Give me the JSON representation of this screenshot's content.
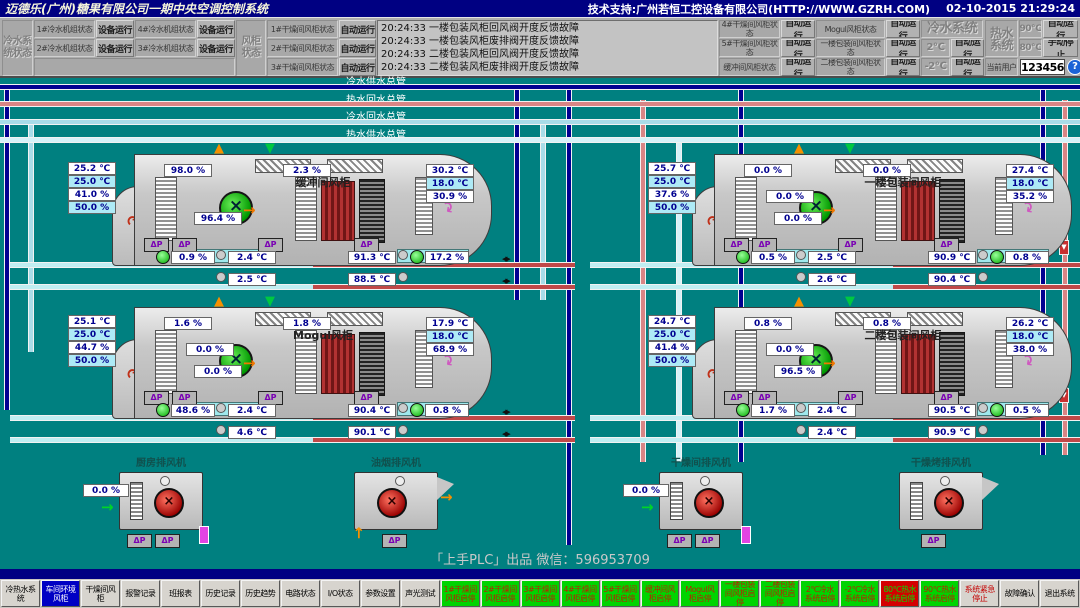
{
  "colors": {
    "background": "#008080",
    "titlebar": "#000082",
    "run_green": "#00d400",
    "stop_red": "#d40000",
    "active_blue": "#0000c4",
    "setpoint_cyan": "#aeeaf6"
  },
  "title_bar": {
    "title": "迈德乐(广州)糖果有限公司一期中央空调控制系统",
    "support": "技术支持:广州若恒工控设备有限公司(HTTP://WWW.GZRH.COM)",
    "datetime": "02-10-2015 21:29:24"
  },
  "labels": {
    "dp": "ΔP"
  },
  "status_panel": {
    "chiller_group": "冷水系统状态",
    "chiller_rows": [
      {
        "l1": "1#冷水机组状态",
        "v1": "设备运行",
        "l2": "4#冷水机组状态",
        "v2": "设备运行"
      },
      {
        "l1": "2#冷水机组状态",
        "v1": "设备运行",
        "l2": "3#冷水机组状态",
        "v2": "设备运行"
      }
    ],
    "ahu_group": "风柜状态",
    "ahu_left_rows": [
      {
        "l": "1#干燥间风柜状态",
        "v": "自动运行"
      },
      {
        "l": "2#干燥间风柜状态",
        "v": "自动运行"
      },
      {
        "l": "3#干燥间风柜状态",
        "v": "自动运行"
      }
    ],
    "alarms": [
      {
        "time": "20:24:33",
        "text": "一楼包装风柜回风阀开度反馈故障"
      },
      {
        "time": "20:24:33",
        "text": "一楼包装风柜废排阀开度反馈故障"
      },
      {
        "time": "20:24:33",
        "text": "二楼包装风柜回风阀开度反馈故障"
      },
      {
        "time": "20:24:33",
        "text": "二楼包装风柜废排阀开度反馈故障"
      }
    ],
    "ahu_right_rows": [
      {
        "l1": "4#干燥间风柜状态",
        "v1": "自动运行",
        "l2": "Mogul风柜状态",
        "v2": "自动运行"
      },
      {
        "l1": "5#干燥间风柜状态",
        "v1": "自动运行",
        "l2": "一楼包装间风柜状态",
        "v2": "自动运行"
      },
      {
        "l1": "缓冲间风柜状态",
        "v1": "自动运行",
        "l2": "二楼包装间风柜状态",
        "v2": "自动运行"
      }
    ],
    "cold_system": {
      "label": "冷水系统",
      "rows": [
        {
          "t": "2℃",
          "s": "自动运行"
        },
        {
          "t": "-2℃",
          "s": "自动运行"
        }
      ]
    },
    "hot_system": {
      "label": "热水系统",
      "rows": [
        {
          "t": "90℃",
          "s": "自动运行"
        },
        {
          "t": "80℃",
          "s": "手动停止"
        }
      ]
    },
    "current_user_label": "当前用户",
    "current_user": "123456",
    "help": "?"
  },
  "pipes": {
    "mains": [
      {
        "label": "冷水供水总管",
        "color": "#000090"
      },
      {
        "label": "热水回水总管",
        "color": "#d98585"
      },
      {
        "label": "冷水回水总管",
        "color": "#a8dce8"
      },
      {
        "label": "热水供水总管",
        "color": "#d6f2f8"
      }
    ]
  },
  "ahus": [
    {
      "name": "缓冲间风柜",
      "left": [
        "25.2 ℃",
        "25.0 ℃",
        "41.0 %",
        "50.0 %"
      ],
      "top": [
        "98.0 %",
        "2.3 %"
      ],
      "right": [
        "30.2 ℃",
        "18.0 ℃",
        "30.9 %"
      ],
      "mid": [
        "96.4 %"
      ],
      "chw_valve": "0.9 %",
      "chw_t1": "2.4 ℃",
      "chw_t2": "2.5 ℃",
      "hw_t1": "91.3 ℃",
      "hw_valve": "17.2 %",
      "hw_t2": "88.5 ℃"
    },
    {
      "name": "一楼包装间风柜",
      "left": [
        "25.7 ℃",
        "25.0 ℃",
        "37.6 %",
        "50.0 %"
      ],
      "top": [
        "0.0 %",
        "0.0 %"
      ],
      "right": [
        "27.4 ℃",
        "18.0 ℃",
        "35.2 %"
      ],
      "mid": [
        "0.0 %",
        "0.0 %"
      ],
      "chw_valve": "0.5 %",
      "chw_t1": "2.5 ℃",
      "chw_t2": "2.6 ℃",
      "hw_t1": "90.9 ℃",
      "hw_valve": "0.8 %",
      "hw_t2": "90.4 ℃"
    },
    {
      "name": "Mogul风柜",
      "left": [
        "25.1 ℃",
        "25.0 ℃",
        "44.7 %",
        "50.0 %"
      ],
      "top": [
        "1.6 %",
        "1.8 %"
      ],
      "right": [
        "17.9 ℃",
        "18.0 ℃",
        "68.9 %"
      ],
      "mid": [
        "0.0 %",
        "0.0 %"
      ],
      "chw_valve": "48.6 %",
      "chw_t1": "2.4 ℃",
      "chw_t2": "4.6 ℃",
      "hw_t1": "90.4 ℃",
      "hw_valve": "0.8 %",
      "hw_t2": "90.1 ℃"
    },
    {
      "name": "二楼包装间风柜",
      "left": [
        "24.7 ℃",
        "25.0 ℃",
        "41.4 %",
        "50.0 %"
      ],
      "top": [
        "0.8 %",
        "0.8 %"
      ],
      "right": [
        "26.2 ℃",
        "18.0 ℃",
        "38.0 %"
      ],
      "mid": [
        "0.0 %",
        "96.5 %"
      ],
      "chw_valve": "1.7 %",
      "chw_t1": "2.4 ℃",
      "chw_t2": "2.4 ℃",
      "hw_t1": "90.5 ℃",
      "hw_valve": "0.5 %",
      "hw_t2": "90.9 ℃"
    }
  ],
  "exhaust_fans": [
    {
      "name": "厨房排风机",
      "damper": "0.0 %"
    },
    {
      "name": "油烟排风机"
    },
    {
      "name": "干燥间排风机",
      "damper": "0.0 %"
    },
    {
      "name": "干燥烤排风机"
    }
  ],
  "footer": {
    "credit": "「上手PLC」出品 微信：596953709"
  },
  "toolbar": {
    "buttons": [
      "冷热水系统",
      "车间环境风柜",
      "干燥间风柜",
      "报警记录",
      "班报表",
      "历史记录",
      "历史趋势",
      "电路状态",
      "I/O状态",
      "参数设置",
      "声光测试",
      "1#干燥间风柜启停",
      "2#干燥间风柜启停",
      "3#干燥间风柜启停",
      "4#干燥间风柜启停",
      "5#干燥间风柜启停",
      "缓冲间风柜启停",
      "Mogul风柜启停",
      "一楼包装间风柜启停",
      "二楼包装间风柜启停",
      "2℃冷水系统启停",
      "-2℃冷水系统启停",
      "80℃热水系统启停",
      "90℃热水系统启停",
      "系统紧急停止",
      "故障确认",
      "退出系统"
    ]
  }
}
